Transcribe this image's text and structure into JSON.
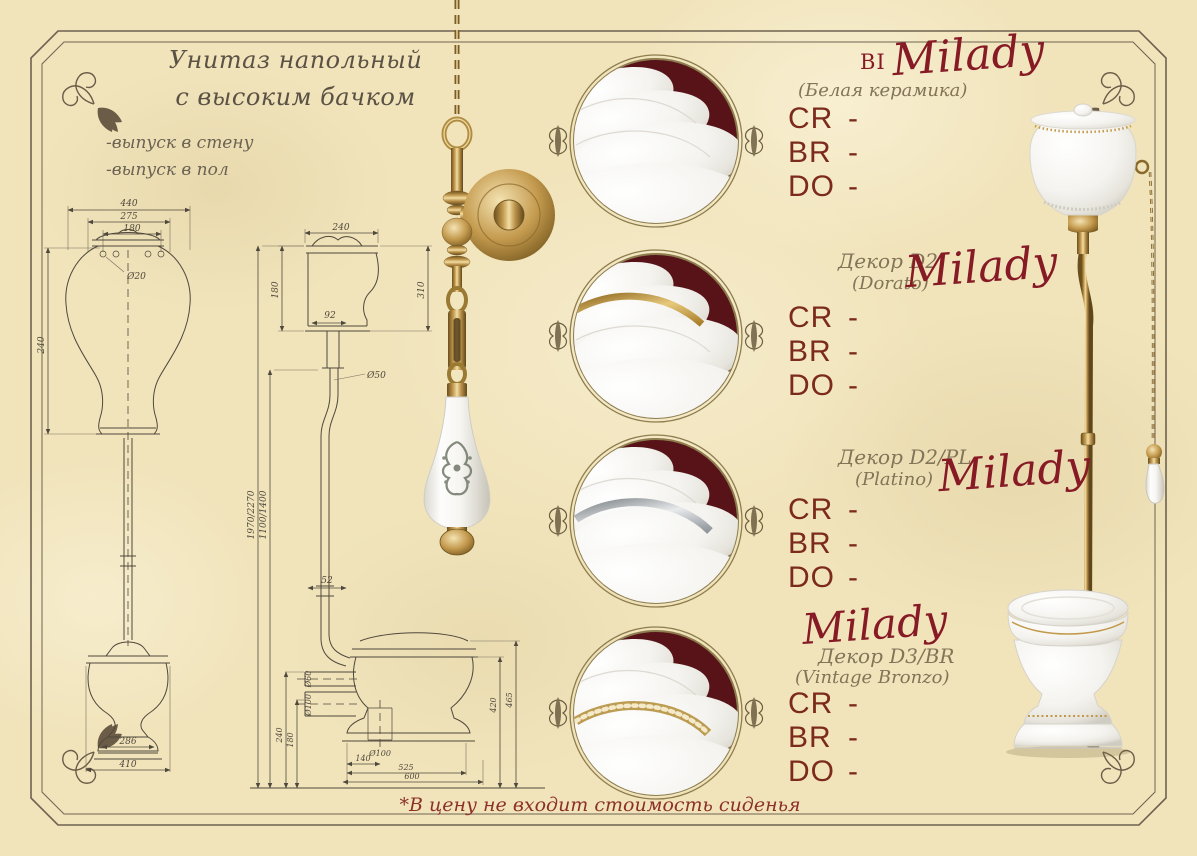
{
  "page": {
    "title_line1": "Унитаз напольный",
    "title_line2": "с высоким бачком",
    "outlet_option1": "-выпуск в стену",
    "outlet_option2": "-выпуск в пол",
    "footnote": "*В цену не входит стоимость сиденья"
  },
  "products": [
    {
      "prefix": "BI",
      "brand": "Milady",
      "finish": "(Белая керамика)",
      "rows": [
        {
          "code": "CR",
          "price": "-"
        },
        {
          "code": "BR",
          "price": "-"
        },
        {
          "code": "DO",
          "price": "-"
        }
      ]
    },
    {
      "decor": "Декор D2",
      "brand": "Milady",
      "finish": "(Dorato)",
      "rows": [
        {
          "code": "CR",
          "price": "-"
        },
        {
          "code": "BR",
          "price": "-"
        },
        {
          "code": "DO",
          "price": "-"
        }
      ]
    },
    {
      "decor": "Декор D2/PL",
      "brand": "Milady",
      "finish": "(Platino)",
      "rows": [
        {
          "code": "CR",
          "price": "-"
        },
        {
          "code": "BR",
          "price": "-"
        },
        {
          "code": "DO",
          "price": "-"
        }
      ]
    },
    {
      "decor": "Декор D3/BR",
      "brand": "Milady",
      "finish": "(Vintage Bronzo)",
      "rows": [
        {
          "code": "CR",
          "price": "-"
        },
        {
          "code": "BR",
          "price": "-"
        },
        {
          "code": "DO",
          "price": "-"
        }
      ]
    }
  ],
  "dims": {
    "f1": "440",
    "f2": "275",
    "f3": "180",
    "f4": "Ø20",
    "f5": "240",
    "f6": "286",
    "f7": "410",
    "s1": "240",
    "s2": "180",
    "s3": "310",
    "s4": "92",
    "s5": "Ø50",
    "p1": "1970/2270",
    "p2": "1100/1400",
    "p3": "52",
    "b1": "Ø60",
    "b2": "Ø100",
    "b3": "240",
    "b4": "180",
    "b5": "420",
    "b6": "465",
    "b7": "Ø100",
    "b8": "140",
    "b9": "525",
    "b10": "600"
  },
  "colors": {
    "parchment": "#f1e4bb",
    "accent_maroon": "#861a25",
    "price_text": "#7b2a1c",
    "medallion_background": "#571318",
    "brass": "#c2994a",
    "frame_line": "#6f6250"
  }
}
